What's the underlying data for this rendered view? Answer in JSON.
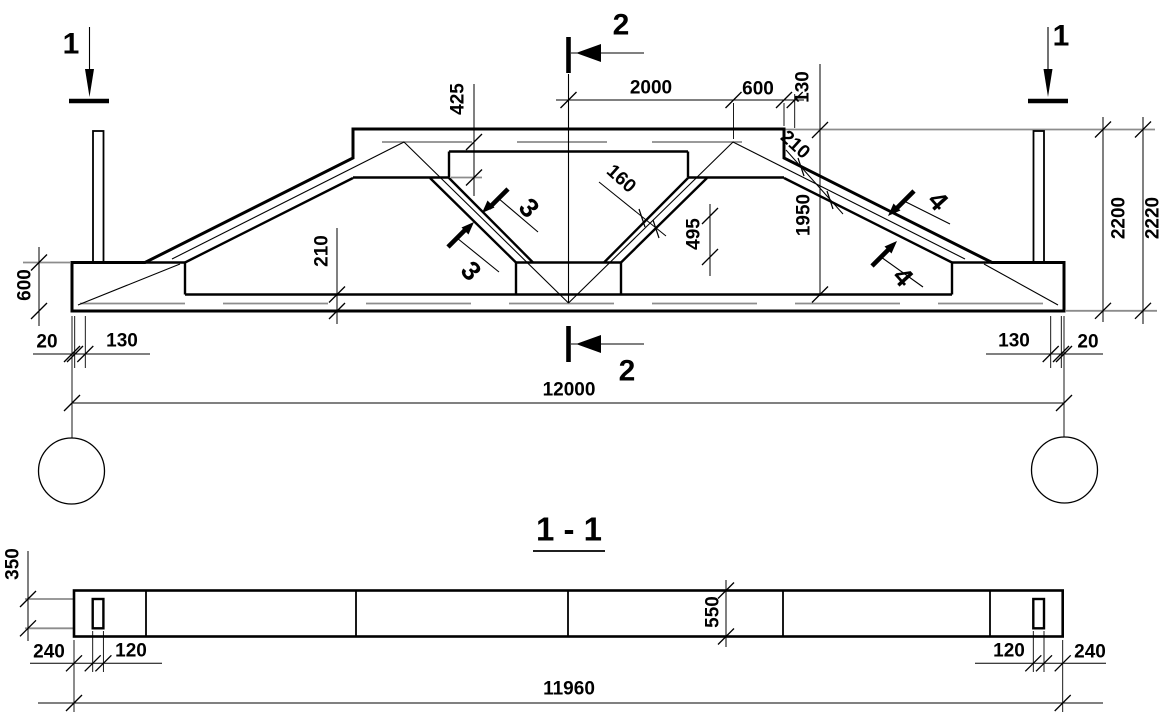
{
  "drawing": {
    "elevation": {
      "cut_markers": {
        "left_1": "1",
        "right_1": "1",
        "top_2": "2",
        "bottom_2": "2",
        "diag3_upper": "3",
        "diag3_lower": "3",
        "chord4_upper": "4",
        "chord4_lower": "4"
      },
      "dims": {
        "top_2000": "2000",
        "top_600": "600",
        "top_130": "130",
        "h_425": "425",
        "diag_160": "160",
        "h_495": "495",
        "slope_210": "210",
        "h_1950": "1950",
        "h_2200": "2200",
        "h_2220": "2220",
        "left_600": "600",
        "chord_210": "210",
        "bottom_left_20": "20",
        "bottom_left_130": "130",
        "span_12000": "12000",
        "bottom_right_130": "130",
        "bottom_right_20": "20"
      }
    },
    "section_1_1": {
      "title": "1 - 1",
      "dims": {
        "w_350": "350",
        "w_550": "550",
        "end_240_left": "240",
        "post_120_left": "120",
        "post_120_right": "120",
        "end_240_right": "240",
        "length_11960": "11960"
      }
    }
  }
}
